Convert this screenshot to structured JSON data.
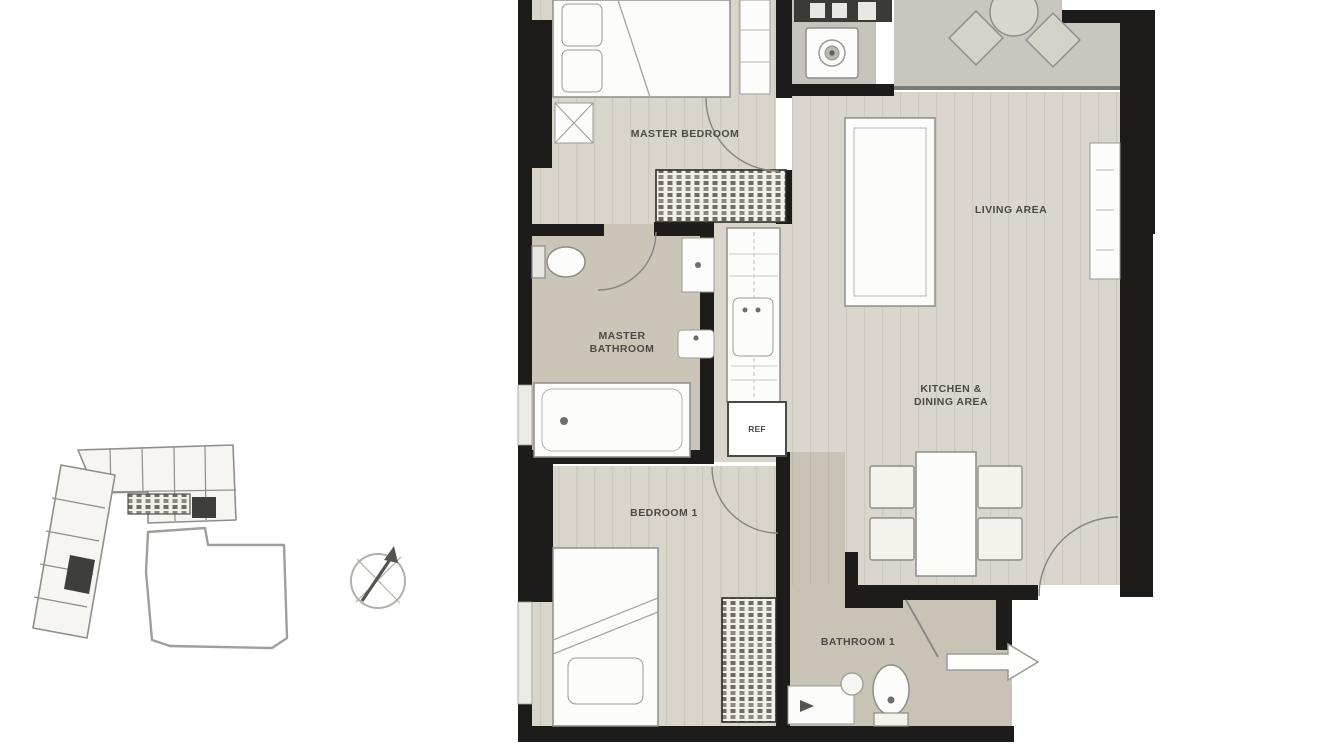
{
  "floor_plan": {
    "rooms": {
      "master_bedroom": {
        "label": "MASTER BEDROOM"
      },
      "master_bathroom": {
        "label_line1": "MASTER",
        "label_line2": "BATHROOM"
      },
      "living_area": {
        "label": "LIVING AREA"
      },
      "kitchen_dining_area": {
        "label_line1": "KITCHEN &",
        "label_line2": "DINING AREA"
      },
      "bedroom_1": {
        "label": "BEDROOM 1"
      },
      "bathroom_1": {
        "label": "BATHROOM 1"
      }
    },
    "appliances": {
      "refrigerator": "REF"
    },
    "icons": {
      "compass": "north-arrow-compass-icon",
      "entry_arrow": "entry-direction-arrow-icon"
    },
    "colors": {
      "wall": "#1d1c1a",
      "floor_light": "#d9d5cb",
      "floor_taupe": "#cbc5b8",
      "balcony_floor": "#c8c6be",
      "window_fill": "#eceae4",
      "furniture_fill": "#fcfcfa",
      "furniture_stroke": "#8d8d89",
      "label_text": "#4b4a45"
    }
  }
}
